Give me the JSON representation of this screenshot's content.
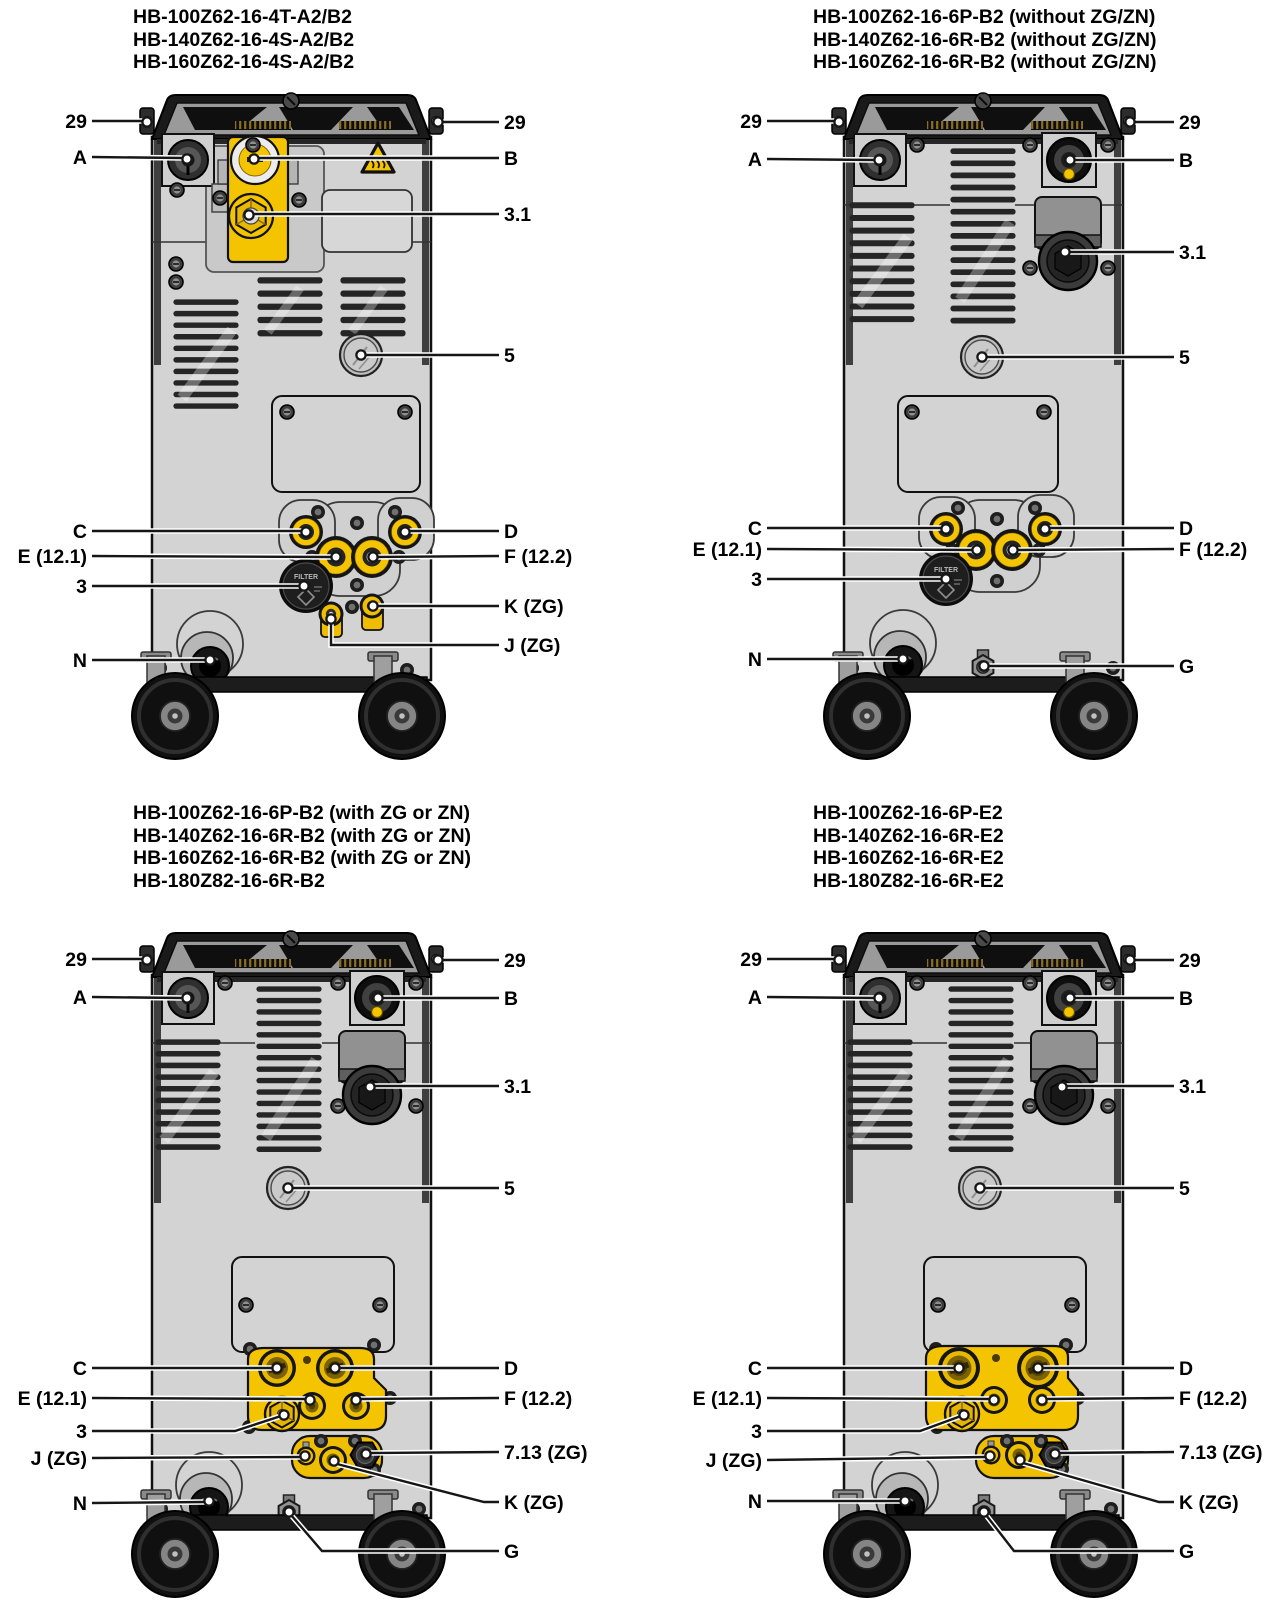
{
  "figure": {
    "filter_cap_text": "FILTER",
    "colors": {
      "accent_yellow": "#F5C400",
      "machine_gray": "#D3D3D3",
      "cap_dark": "#1A1A1A",
      "leader_line": "#161616"
    },
    "panels": [
      {
        "id": "top-left",
        "title_lines": [
          "HB-100Z62-16-4T-A2/B2",
          "HB-140Z62-16-4S-A2/B2",
          "HB-160Z62-16-4S-A2/B2"
        ],
        "callouts": {
          "c29l": "29",
          "c29r": "29",
          "a": "A",
          "b": "B",
          "f31": "3.1",
          "p5": "5",
          "c": "C",
          "d": "D",
          "e": "E (12.1)",
          "f": "F (12.2)",
          "n3": "3",
          "k": "K (ZG)",
          "j": "J (ZG)",
          "n": "N"
        }
      },
      {
        "id": "top-right",
        "title_lines": [
          "HB-100Z62-16-6P-B2 (without ZG/ZN)",
          "HB-140Z62-16-6R-B2 (without ZG/ZN)",
          "HB-160Z62-16-6R-B2 (without ZG/ZN)"
        ],
        "callouts": {
          "c29l": "29",
          "c29r": "29",
          "a": "A",
          "b": "B",
          "f31": "3.1",
          "p5": "5",
          "c": "C",
          "d": "D",
          "e": "E (12.1)",
          "f": "F (12.2)",
          "n3": "3",
          "n": "N",
          "g": "G"
        }
      },
      {
        "id": "bottom-left",
        "title_lines": [
          "HB-100Z62-16-6P-B2 (with ZG or ZN)",
          "HB-140Z62-16-6R-B2 (with ZG or ZN)",
          "HB-160Z62-16-6R-B2 (with ZG or ZN)",
          "HB-180Z82-16-6R-B2"
        ],
        "callouts": {
          "c29l": "29",
          "c29r": "29",
          "a": "A",
          "b": "B",
          "f31": "3.1",
          "p5": "5",
          "c": "C",
          "d": "D",
          "e": "E (12.1)",
          "f": "F (12.2)",
          "n3": "3",
          "j": "J (ZG)",
          "z713": "7.13 (ZG)",
          "k": "K (ZG)",
          "n": "N",
          "g": "G"
        }
      },
      {
        "id": "bottom-right",
        "title_lines": [
          "HB-100Z62-16-6P-E2",
          "HB-140Z62-16-6R-E2",
          "HB-160Z62-16-6R-E2",
          "HB-180Z82-16-6R-E2"
        ],
        "callouts": {
          "c29l": "29",
          "c29r": "29",
          "a": "A",
          "b": "B",
          "f31": "3.1",
          "p5": "5",
          "c": "C",
          "d": "D",
          "e": "E (12.1)",
          "f": "F (12.2)",
          "n3": "3",
          "j": "J (ZG)",
          "z713": "7.13 (ZG)",
          "k": "K (ZG)",
          "n": "N",
          "g": "G"
        }
      }
    ]
  }
}
